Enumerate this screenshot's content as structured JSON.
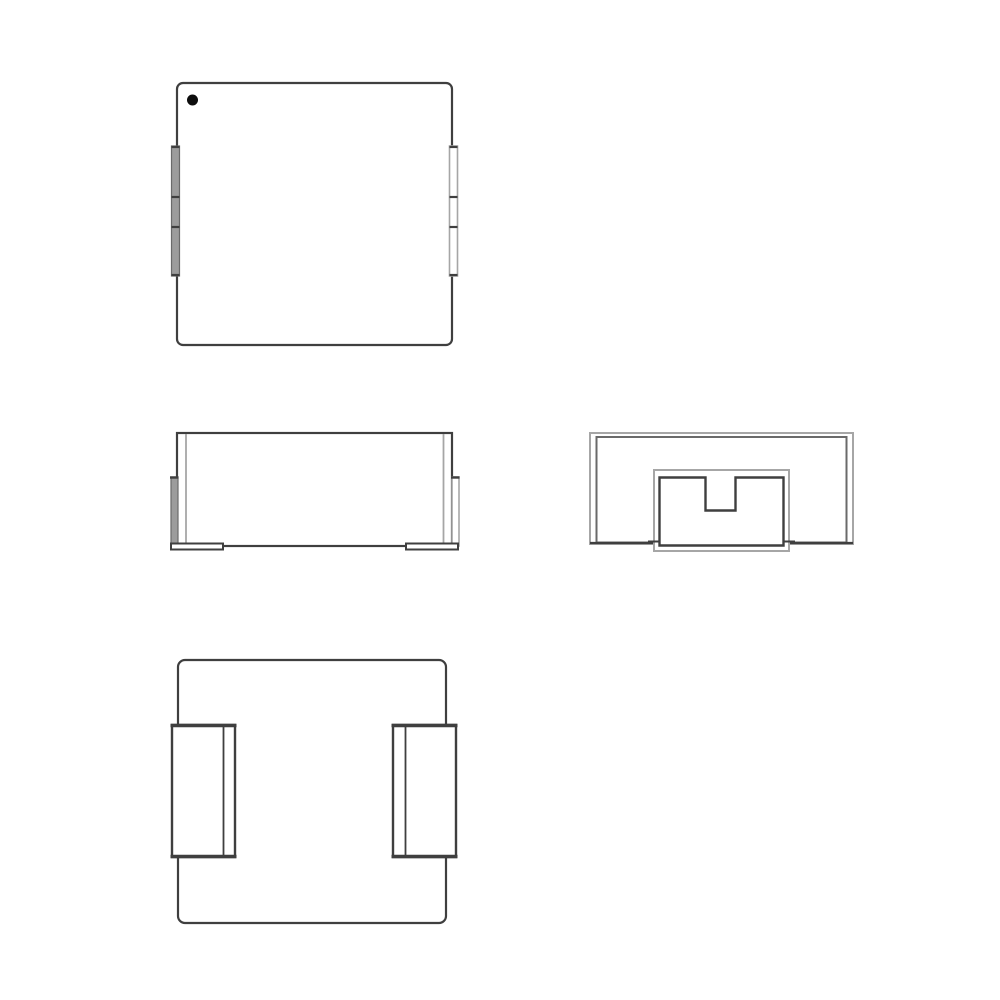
{
  "page": {
    "background": "#ffffff"
  },
  "colors": {
    "line_dark": "#3f3f3f",
    "line_mid": "#6a6a6a",
    "line_light": "#a6a6a6",
    "terminal_gray": "#9c9c9c",
    "marker_black": "#0d0d0d",
    "body_fill": "#ffffff",
    "page_bg": "#ffffff"
  },
  "drawing": {
    "views": [
      "top-view",
      "front-view",
      "end-view",
      "bottom-view"
    ],
    "marker": "pin-1-index-dot"
  }
}
